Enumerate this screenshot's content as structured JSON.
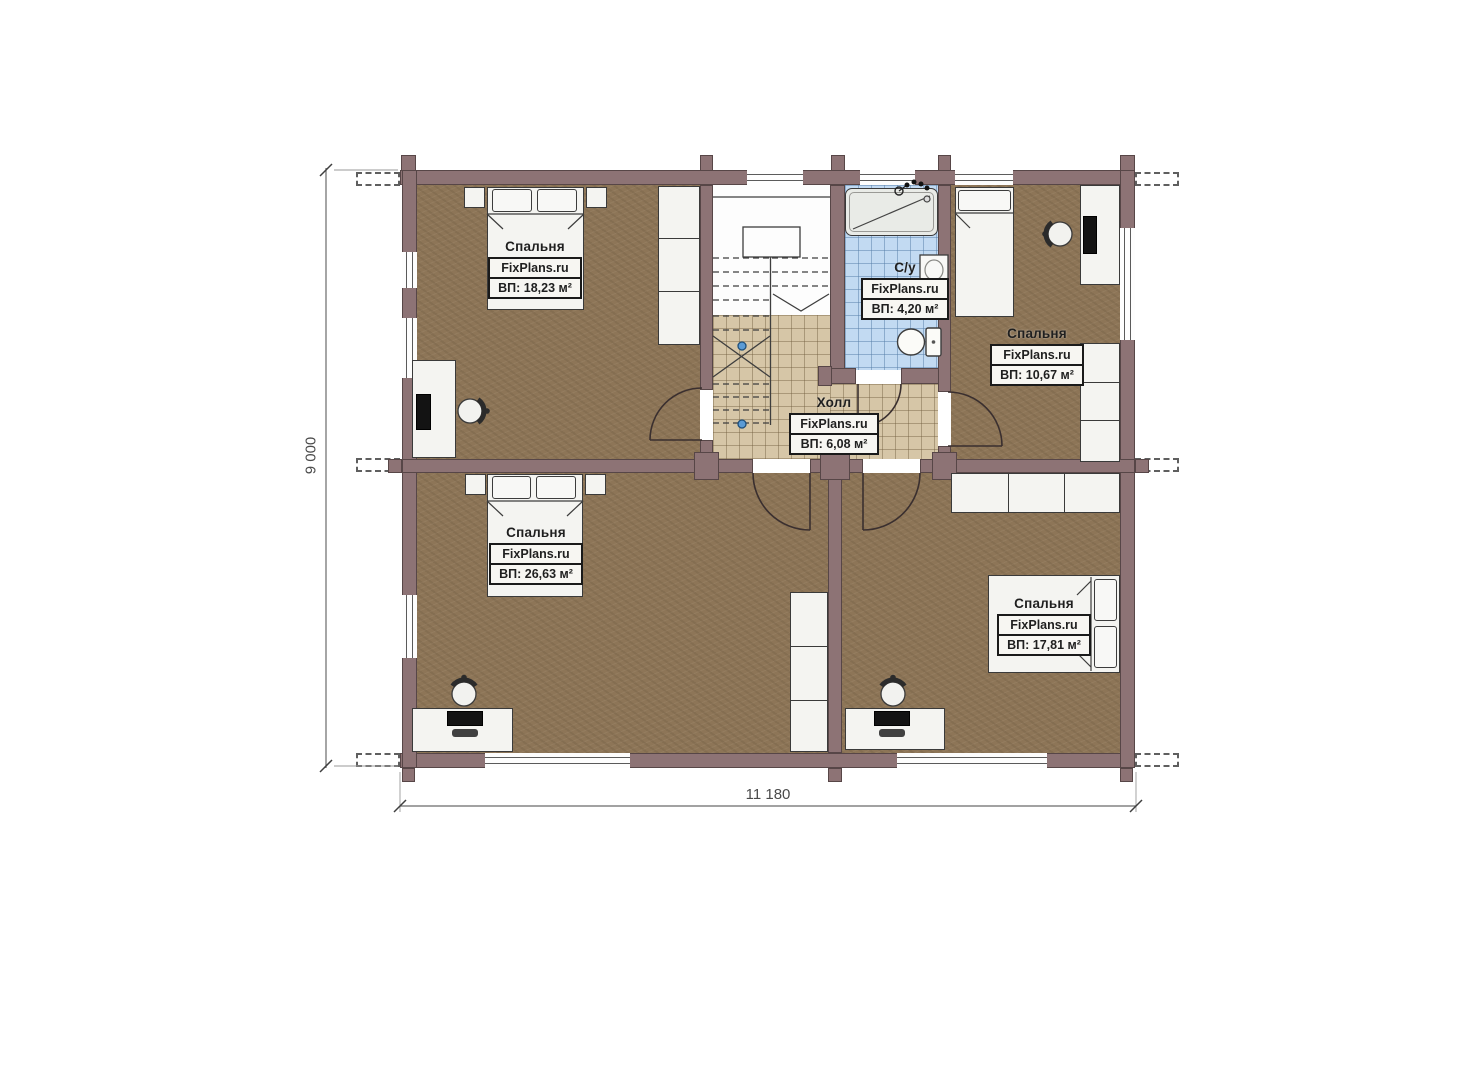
{
  "plan_title": "floor-plan-second-floor",
  "rooms": [
    {
      "id": "bedroom-top-left",
      "name": "Спальня",
      "brand": "FixPlans.ru",
      "area": "ВП: 18,23 м²"
    },
    {
      "id": "bedroom-top-right",
      "name": "Спальня",
      "brand": "FixPlans.ru",
      "area": "ВП: 10,67 м²"
    },
    {
      "id": "bathroom",
      "name": "С/у",
      "brand": "FixPlans.ru",
      "area": "ВП: 4,20 м²"
    },
    {
      "id": "hall",
      "name": "Холл",
      "brand": "FixPlans.ru",
      "area": "ВП: 6,08 м²"
    },
    {
      "id": "bedroom-bottom-left",
      "name": "Спальня",
      "brand": "FixPlans.ru",
      "area": "ВП: 26,63 м²"
    },
    {
      "id": "bedroom-bottom-right",
      "name": "Спальня",
      "brand": "FixPlans.ru",
      "area": "ВП: 17,81 м²"
    }
  ],
  "dimensions": {
    "height": "9 000",
    "width": "11 180"
  },
  "colors": {
    "wall": "#8d7375",
    "floor": "#8d7557",
    "hall_tile": "#d6c6a7",
    "bath_tile": "#c2daf2",
    "accent": "#5b9bd5"
  }
}
